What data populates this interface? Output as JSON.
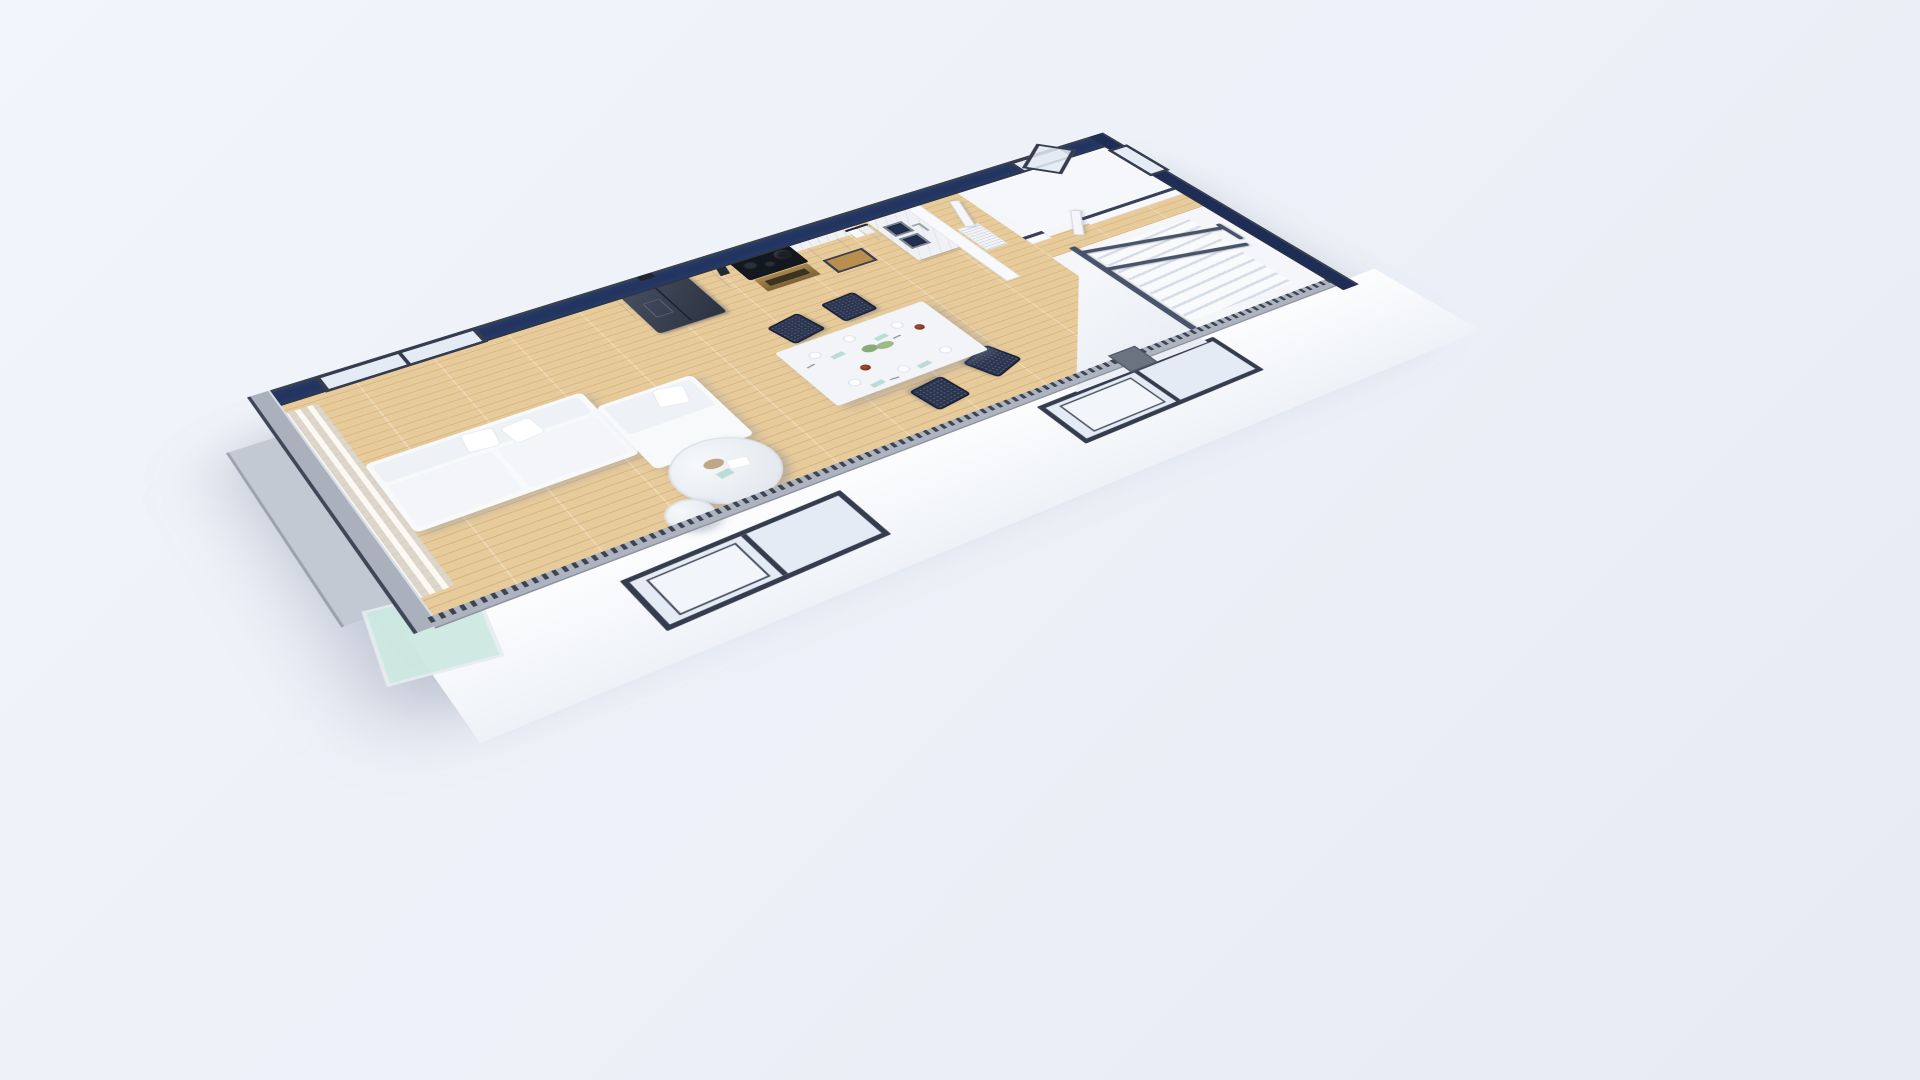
{
  "scene": {
    "type": "architectural-3d-cutaway-floor-plan",
    "view": "isometric aerial perspective render",
    "background_top": "#f2f5fb",
    "background_bottom": "#e6ebf4"
  },
  "colors": {
    "bg_top": "#f2f5fb",
    "bg_bottom": "#e6ebf4",
    "wall_top": "#1d2d55",
    "wall_trim": "#39414f",
    "wall_face": "#f7f9fc",
    "wood": "#e7cb9b",
    "marble": "#eff1f4",
    "cabinet": "#e3e7ed",
    "fridge": "#343c4b",
    "cooktop": "#14171d",
    "oven": "#94763f",
    "basin": "#243052",
    "chair": "#2b3550",
    "table": "#f2f4f8",
    "sofa": "#f8f9fb",
    "rail": "#49536a",
    "frame": "#353c4e",
    "glass": "#e4ebf4",
    "balcony_glass": "#cde9e1",
    "curtain": "#eef1f5",
    "napkin": "#b9dcd7",
    "bowl": "#76301f",
    "plant": "#7da368",
    "tooth": "#3c4352",
    "tooth_bg": "#aeb4bf"
  },
  "building": {
    "floor_material": "light oak plank",
    "wall_finish": "white plaster, cut tops shown navy with slate trim",
    "front_wall_section": "serrated brick-section strip"
  },
  "rooms": [
    {
      "id": "living-room",
      "furniture": [
        "l-shaped-sectional-sofa",
        "throw-pillows",
        "round-marble-coffee-table-large",
        "round-marble-coffee-table-small",
        "sheer-curtains",
        "sliding-glass-wall",
        "balcony-slab",
        "balcony-glass-panel"
      ]
    },
    {
      "id": "dining-area",
      "furniture": [
        "white-dining-table",
        "navy-lattice-chairs",
        "place-settings",
        "plant-centerpiece",
        "serving-bowls"
      ]
    },
    {
      "id": "kitchen",
      "furniture": [
        "side-by-side-refrigerator",
        "black-cooktop",
        "brass-oven",
        "kettle",
        "knife-block",
        "towel-rail",
        "microwave-niche",
        "double-basin-sink",
        "faucet",
        "upper-cabinets",
        "base-cabinets",
        "marble-backsplash"
      ]
    },
    {
      "id": "hallway",
      "furniture": [
        "wall-niche-radiator"
      ]
    },
    {
      "id": "bathroom",
      "furniture": [
        "open-white-door"
      ]
    },
    {
      "id": "staircase",
      "furniture": [
        "white-steps",
        "metal-handrails",
        "stairwell-wall"
      ]
    }
  ],
  "openings": {
    "windows": [
      {
        "id": "living-back-window",
        "type": "2-pane slider",
        "frame": "#353c4e"
      },
      {
        "id": "front-window-left",
        "type": "2-pane slider",
        "frame": "#39404f"
      },
      {
        "id": "front-window-right",
        "type": "2-pane slider",
        "frame": "#39404f"
      },
      {
        "id": "back-casement-window",
        "type": "open casement",
        "frame": "#39404f"
      },
      {
        "id": "bathroom-end-window",
        "type": "fixed pane",
        "frame": "#39404f"
      }
    ],
    "doors": [
      {
        "id": "bathroom-door",
        "state": "open"
      },
      {
        "id": "closet-door",
        "state": "ajar"
      }
    ]
  },
  "dining_setting": {
    "chairs": 4,
    "plates": 6,
    "napkins": 4,
    "bowls": 2,
    "napkin_color": "#b9dcd7",
    "bowl_color": "#76301f"
  }
}
